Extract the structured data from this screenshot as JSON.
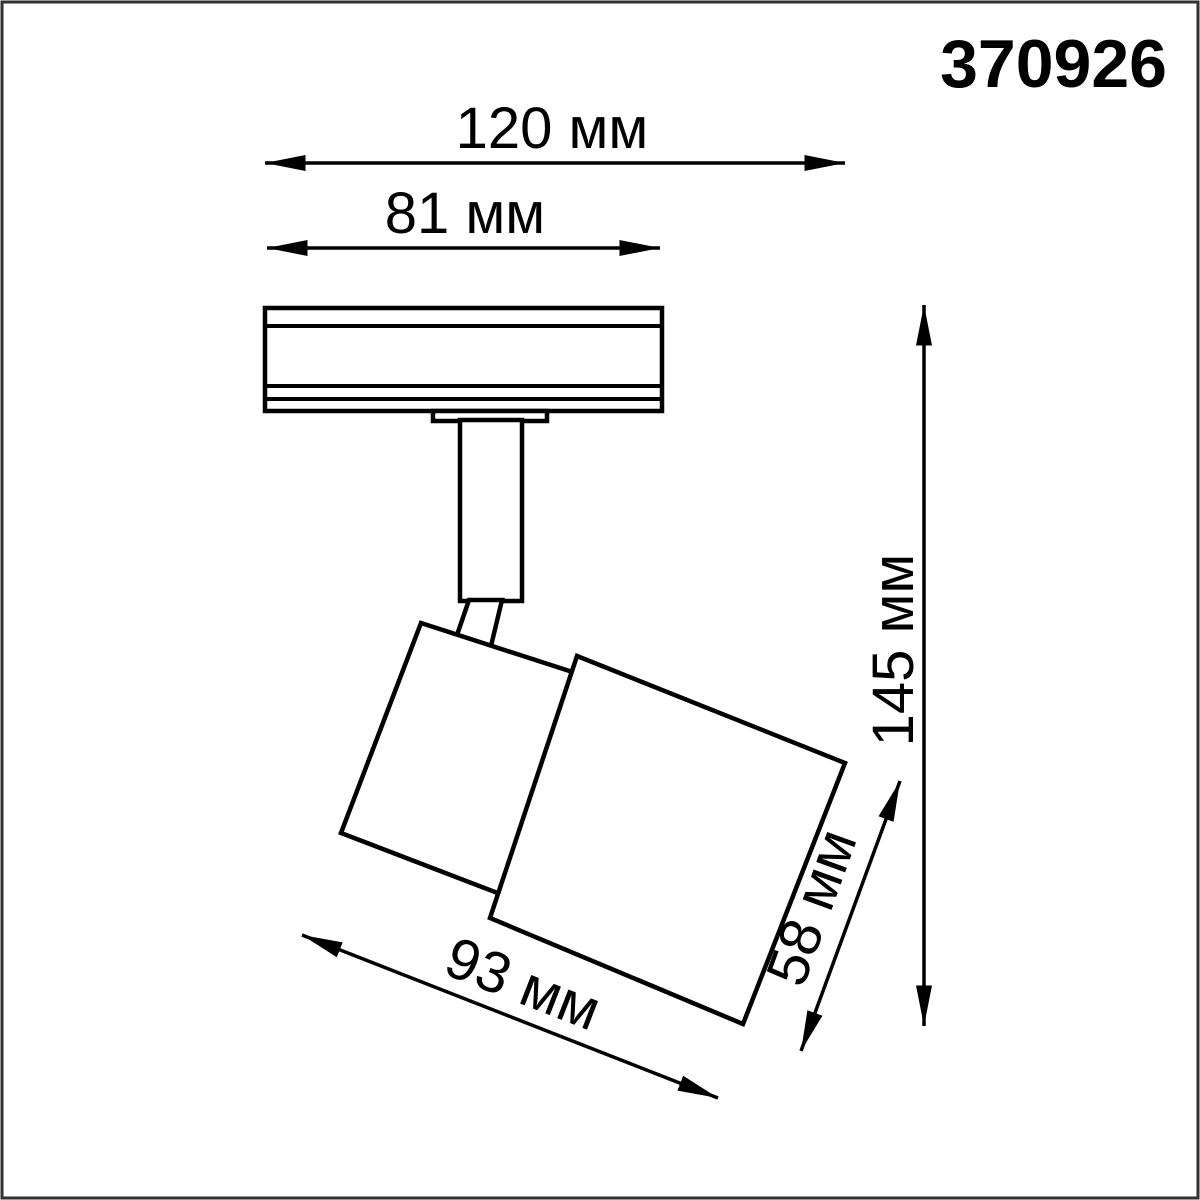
{
  "product_code": "370926",
  "dimensions": {
    "overall_width": {
      "label": "120 мм",
      "value_mm": 120
    },
    "track_adapter_width": {
      "label": "81 мм",
      "value_mm": 81
    },
    "overall_height": {
      "label": "145 мм",
      "value_mm": 145
    },
    "body_length": {
      "label": "93 мм",
      "value_mm": 93
    },
    "body_diameter": {
      "label": "58 мм",
      "value_mm": 58
    }
  },
  "colors": {
    "ink": "#000000",
    "background": "#ffffff",
    "frame": "#2f2f2f"
  },
  "drawing": {
    "type": "technical-dimension-drawing",
    "subject": "track-mounted spot light fixture, side view, head tilted"
  }
}
